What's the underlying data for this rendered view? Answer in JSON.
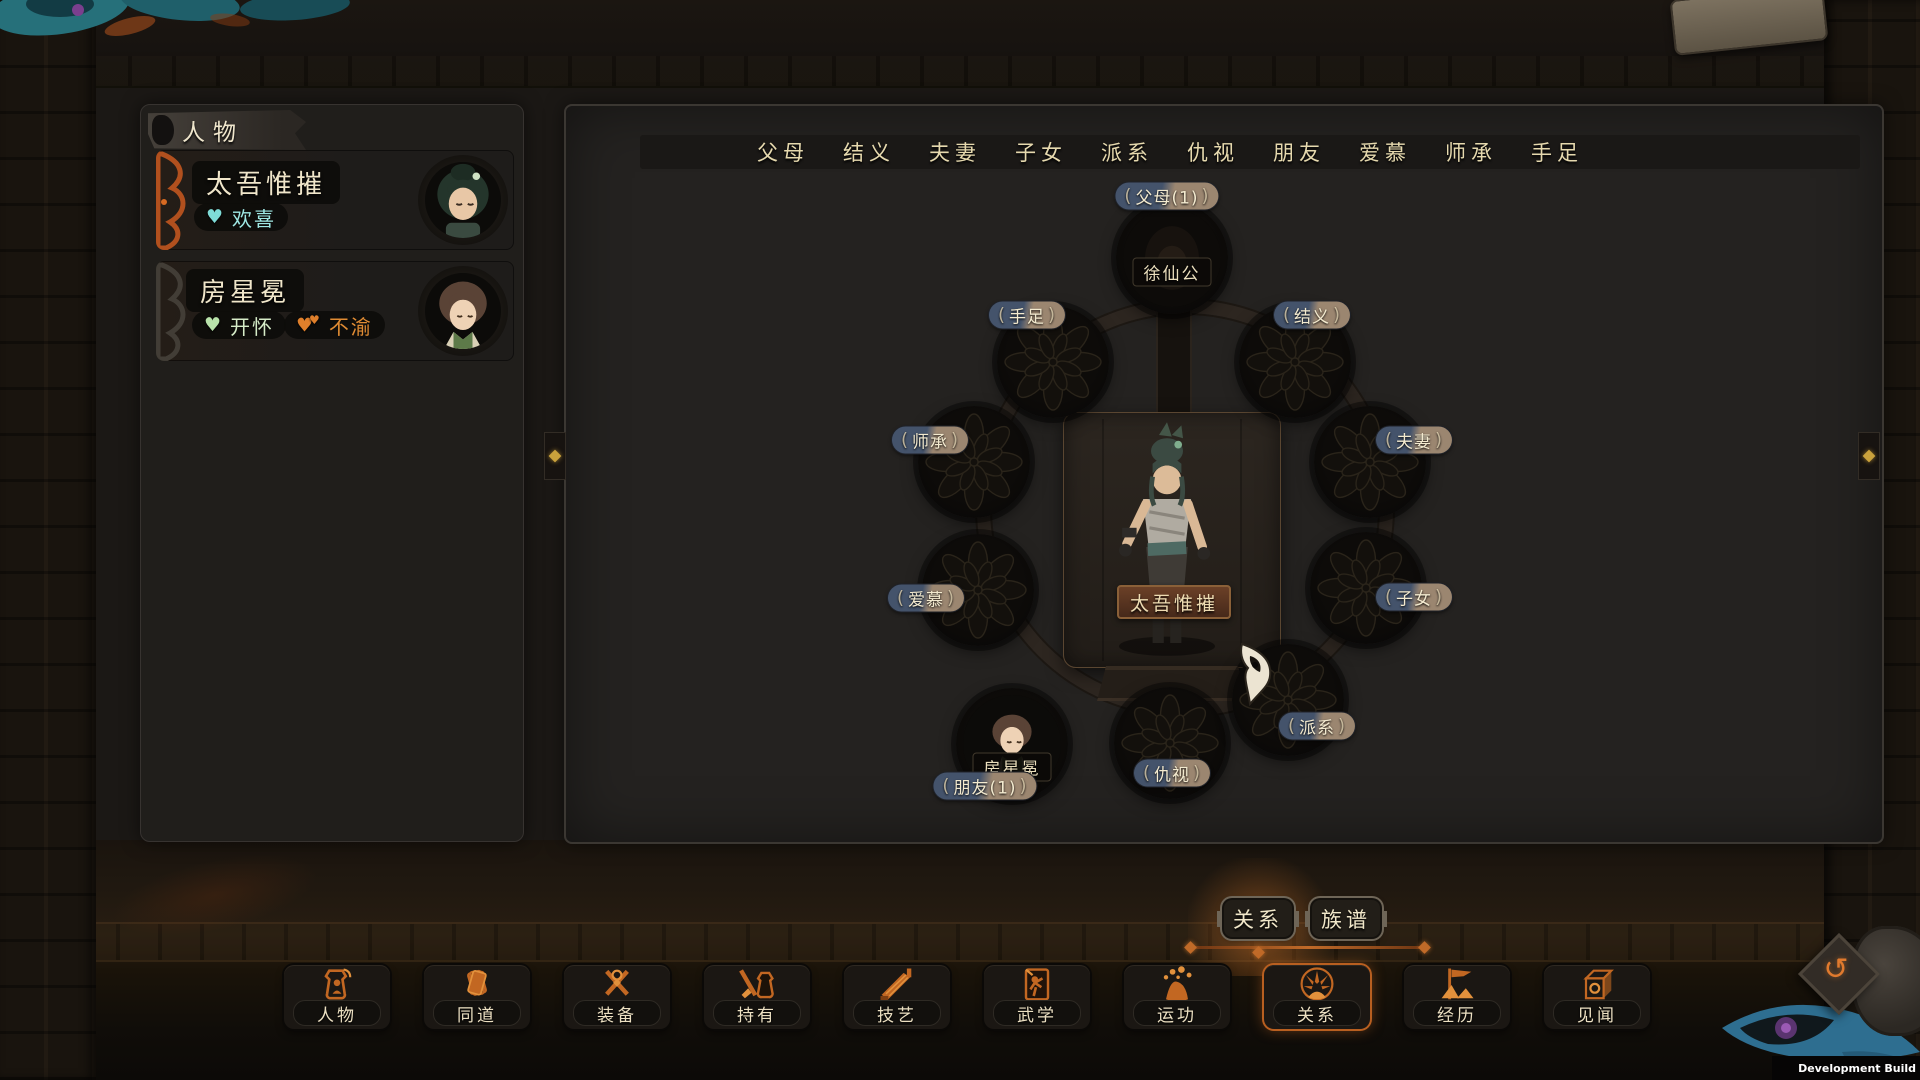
{
  "app": {
    "dev_build_label": "Development Build"
  },
  "sidebar": {
    "header": "人物",
    "characters": [
      {
        "name": "太吾惟摧",
        "moods": [
          {
            "label": "欢喜",
            "color": "#9fe8e4"
          }
        ]
      },
      {
        "name": "房星冕",
        "moods": [
          {
            "label": "开怀",
            "color": "#d6ecc8"
          },
          {
            "label": "不渝",
            "color": "#e08b33"
          }
        ]
      }
    ]
  },
  "relation_tabs": [
    "父母",
    "结义",
    "夫妻",
    "子女",
    "派系",
    "仇视",
    "朋友",
    "爱慕",
    "师承",
    "手足"
  ],
  "wheel": {
    "center": {
      "name": "太吾惟摧"
    },
    "nodes": {
      "parents": {
        "label": "父母(1)",
        "person": "徐仙公"
      },
      "siblings": {
        "label": "手足"
      },
      "sworn": {
        "label": "结义"
      },
      "master": {
        "label": "师承"
      },
      "spouse": {
        "label": "夫妻"
      },
      "admire": {
        "label": "爱慕"
      },
      "children": {
        "label": "子女"
      },
      "friends": {
        "label": "朋友(1)",
        "person": "房星冕"
      },
      "enemy": {
        "label": "仇视"
      },
      "faction": {
        "label": "派系"
      }
    }
  },
  "view_tabs": {
    "relations": "关系",
    "genealogy": "族谱"
  },
  "bottom_nav": [
    "人物",
    "同道",
    "装备",
    "持有",
    "技艺",
    "武学",
    "运功",
    "关系",
    "经历",
    "见闻"
  ],
  "colors": {
    "accent_orange": "#c96b2e",
    "badge_blue": "#44536b",
    "badge_tan": "#9b8670",
    "text_cream": "#e9dfc0",
    "mood_cyan": "#9fe8e4",
    "mood_green": "#d6ecc8",
    "mood_orange": "#e08b33"
  }
}
